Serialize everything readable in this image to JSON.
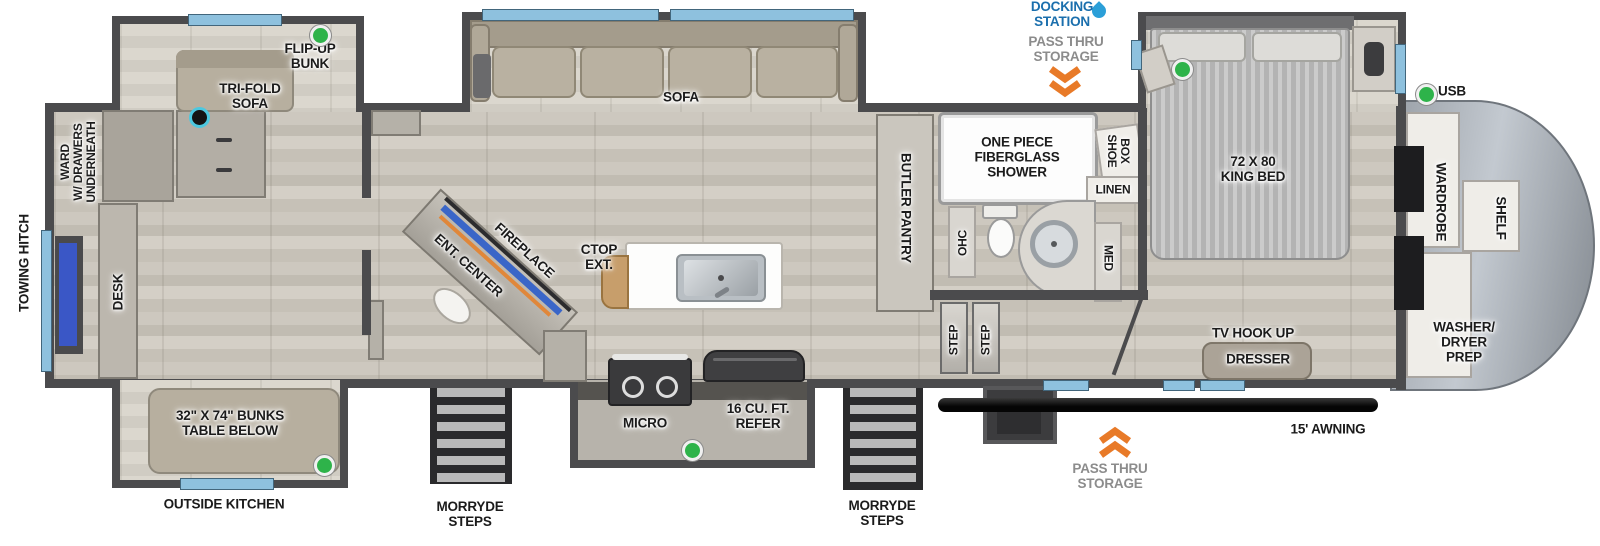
{
  "exterior": {
    "towing_hitch": "TOWING HITCH",
    "outside_kitchen": "OUTSIDE KITCHEN",
    "morryde_steps": "MORRYDE\nSTEPS",
    "awning": "15' AWNING",
    "docking_station": "DOCKING\nSTATION",
    "pass_thru_storage": "PASS THRU\nSTORAGE",
    "usb": "USB"
  },
  "bunk_room": {
    "ward": "WARD\nW/ DRAWERS\nUNDERNEATH",
    "desk": "DESK",
    "flip_up_bunk": "FLIP-UP\nBUNK",
    "tri_fold_sofa": "TRI-FOLD\nSOFA",
    "bunks": "32\" X 74\" BUNKS\nTABLE BELOW"
  },
  "living": {
    "sofa": "SOFA",
    "fireplace": "FIREPLACE",
    "ent_center": "ENT. CENTER",
    "ctop_ext": "CTOP\nEXT."
  },
  "kitchen": {
    "micro": "MICRO",
    "refer": "16 CU. FT.\nREFER"
  },
  "bath": {
    "butler_pantry": "BUTLER PANTRY",
    "shower": "ONE PIECE\nFIBERGLASS\nSHOWER",
    "shoe_box": [
      "SHOE",
      "BOX"
    ],
    "linen": "LINEN",
    "ohc": "OHC",
    "med": "MED",
    "step": "STEP"
  },
  "bedroom": {
    "king_bed": "72 X 80\nKING BED",
    "tv_hook_up": "TV HOOK UP",
    "dresser": "DRESSER"
  },
  "rear": {
    "wardrobe": "WARDROBE",
    "shelf": "SHELF",
    "washer_dryer": "WASHER/\nDRYER\nPREP"
  },
  "colors": {
    "wall": "#4b4b4d",
    "window_blue": "#8ec1de",
    "accent_blue": "#1b6fad",
    "chevron_orange": "#e87a28",
    "dot_green": "#2eb34a",
    "dot_ring_cyan": "#4cc8e0",
    "floor_wood": "#cdc8bf"
  }
}
